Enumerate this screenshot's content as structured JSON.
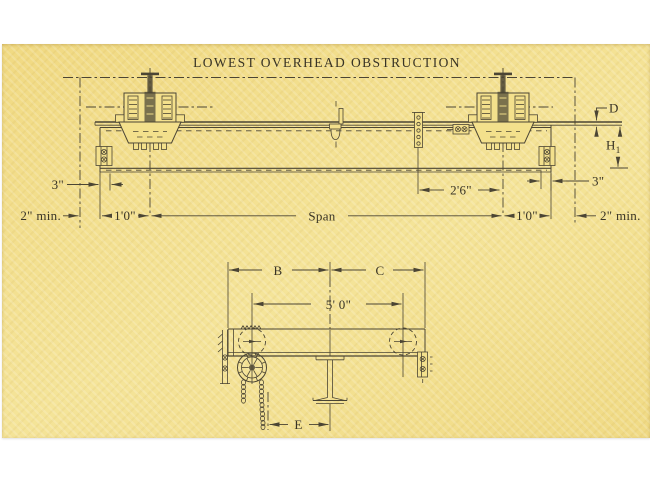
{
  "title": "LOWEST OVERHEAD OBSTRUCTION",
  "colors": {
    "paper": "#f3e08c",
    "ink": "#4b4534",
    "text": "#383325",
    "margin": "#ffffff"
  },
  "elevation": {
    "d": "D",
    "h1_base": "H",
    "h1_sub": "1",
    "left_3in": "3\"",
    "left_2min": "2\" min.",
    "left_1ft": "1'0\"",
    "span": "Span",
    "c2ft6": "2'6\"",
    "right_1ft": "1'0\"",
    "right_2min": "2\" min.",
    "right_3in": "3\""
  },
  "end_view": {
    "b": "B",
    "c": "C",
    "w5ft": "5' 0\"",
    "e": "E"
  }
}
